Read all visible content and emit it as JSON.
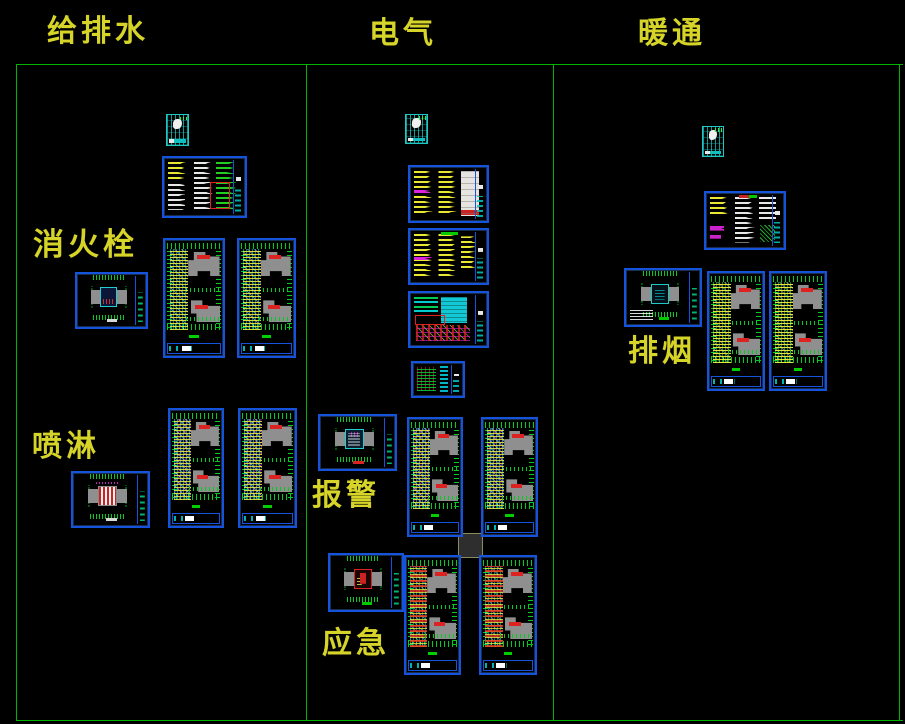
{
  "window": {
    "width": 905,
    "height": 724,
    "background": "#000000"
  },
  "columns": [
    {
      "header": "给排水",
      "sections": [
        "消火栓",
        "喷淋"
      ]
    },
    {
      "header": "电气",
      "sections": [
        "报警",
        "应急"
      ]
    },
    {
      "header": "暖通",
      "sections": [
        "排烟"
      ]
    }
  ],
  "colors": {
    "background": "#000000",
    "divider_green": "#00b400",
    "label_yellow": "#d6d428",
    "sheet_border_blue": "#1553dc",
    "cover_sheet_teal": "#1ec8c4",
    "building_gray": "#8f8f8f",
    "annotation_red": "#dd2222",
    "annotation_magenta": "#cc22cc",
    "annotation_cyan": "#00cccc",
    "annotation_green": "#00cc22",
    "annotation_yellow": "#e8e832"
  },
  "canvas": {
    "sheets": [
      {
        "name": "plumbing-cover",
        "type": "cover",
        "variant": "none",
        "x": 166,
        "y": 114,
        "w": 23,
        "h": 32
      },
      {
        "name": "plumbing-spec",
        "type": "spec",
        "variant": "water",
        "x": 162,
        "y": 156,
        "w": 85,
        "h": 62
      },
      {
        "name": "hydrant-site",
        "type": "site",
        "variant": "hydrant",
        "x": 75,
        "y": 272,
        "w": 73,
        "h": 57
      },
      {
        "name": "hydrant-plan-1",
        "type": "plan",
        "variant": "hydrant",
        "x": 163,
        "y": 238,
        "w": 62,
        "h": 120
      },
      {
        "name": "hydrant-plan-2",
        "type": "plan",
        "variant": "hydrant",
        "x": 237,
        "y": 238,
        "w": 59,
        "h": 120
      },
      {
        "name": "sprinkler-plan-1",
        "type": "plan",
        "variant": "sprinkler",
        "x": 168,
        "y": 408,
        "w": 56,
        "h": 120
      },
      {
        "name": "sprinkler-plan-2",
        "type": "plan",
        "variant": "sprinkler",
        "x": 238,
        "y": 408,
        "w": 59,
        "h": 120
      },
      {
        "name": "sprinkler-site",
        "type": "site",
        "variant": "sprinkler",
        "x": 71,
        "y": 471,
        "w": 79,
        "h": 57
      },
      {
        "name": "electrical-cover",
        "type": "cover",
        "variant": "none",
        "x": 405,
        "y": 114,
        "w": 23,
        "h": 30
      },
      {
        "name": "electrical-spec-1",
        "type": "spec",
        "variant": "elec1",
        "x": 408,
        "y": 165,
        "w": 81,
        "h": 58
      },
      {
        "name": "electrical-spec-2",
        "type": "spec",
        "variant": "elec2",
        "x": 408,
        "y": 228,
        "w": 81,
        "h": 57
      },
      {
        "name": "electrical-detail",
        "type": "spec",
        "variant": "detail",
        "x": 408,
        "y": 291,
        "w": 81,
        "h": 57
      },
      {
        "name": "electrical-detail-sm",
        "type": "spec",
        "variant": "small",
        "x": 411,
        "y": 361,
        "w": 54,
        "h": 37
      },
      {
        "name": "alarm-site",
        "type": "site",
        "variant": "alarm",
        "x": 318,
        "y": 414,
        "w": 79,
        "h": 57
      },
      {
        "name": "alarm-plan-1",
        "type": "plan",
        "variant": "alarm",
        "x": 407,
        "y": 417,
        "w": 56,
        "h": 120
      },
      {
        "name": "alarm-plan-2",
        "type": "plan",
        "variant": "alarm",
        "x": 481,
        "y": 417,
        "w": 57,
        "h": 120
      },
      {
        "name": "emergency-site",
        "type": "site",
        "variant": "emergency",
        "x": 328,
        "y": 553,
        "w": 76,
        "h": 59
      },
      {
        "name": "emergency-plan-1",
        "type": "plan",
        "variant": "emergency",
        "x": 404,
        "y": 555,
        "w": 57,
        "h": 120
      },
      {
        "name": "emergency-plan-2",
        "type": "plan",
        "variant": "emergency",
        "x": 479,
        "y": 555,
        "w": 58,
        "h": 120
      },
      {
        "name": "hvac-cover",
        "type": "cover",
        "variant": "none",
        "x": 702,
        "y": 126,
        "w": 22,
        "h": 31
      },
      {
        "name": "hvac-spec",
        "type": "spec",
        "variant": "hvac",
        "x": 704,
        "y": 191,
        "w": 82,
        "h": 59
      },
      {
        "name": "smoke-site",
        "type": "site",
        "variant": "smoke",
        "x": 624,
        "y": 268,
        "w": 78,
        "h": 59
      },
      {
        "name": "smoke-plan-1",
        "type": "plan",
        "variant": "smoke",
        "x": 707,
        "y": 271,
        "w": 58,
        "h": 120
      },
      {
        "name": "smoke-plan-2",
        "type": "plan",
        "variant": "smoke",
        "x": 769,
        "y": 271,
        "w": 58,
        "h": 120
      }
    ],
    "placeholder_square": {
      "x": 458,
      "y": 533,
      "w": 25,
      "h": 25
    }
  }
}
